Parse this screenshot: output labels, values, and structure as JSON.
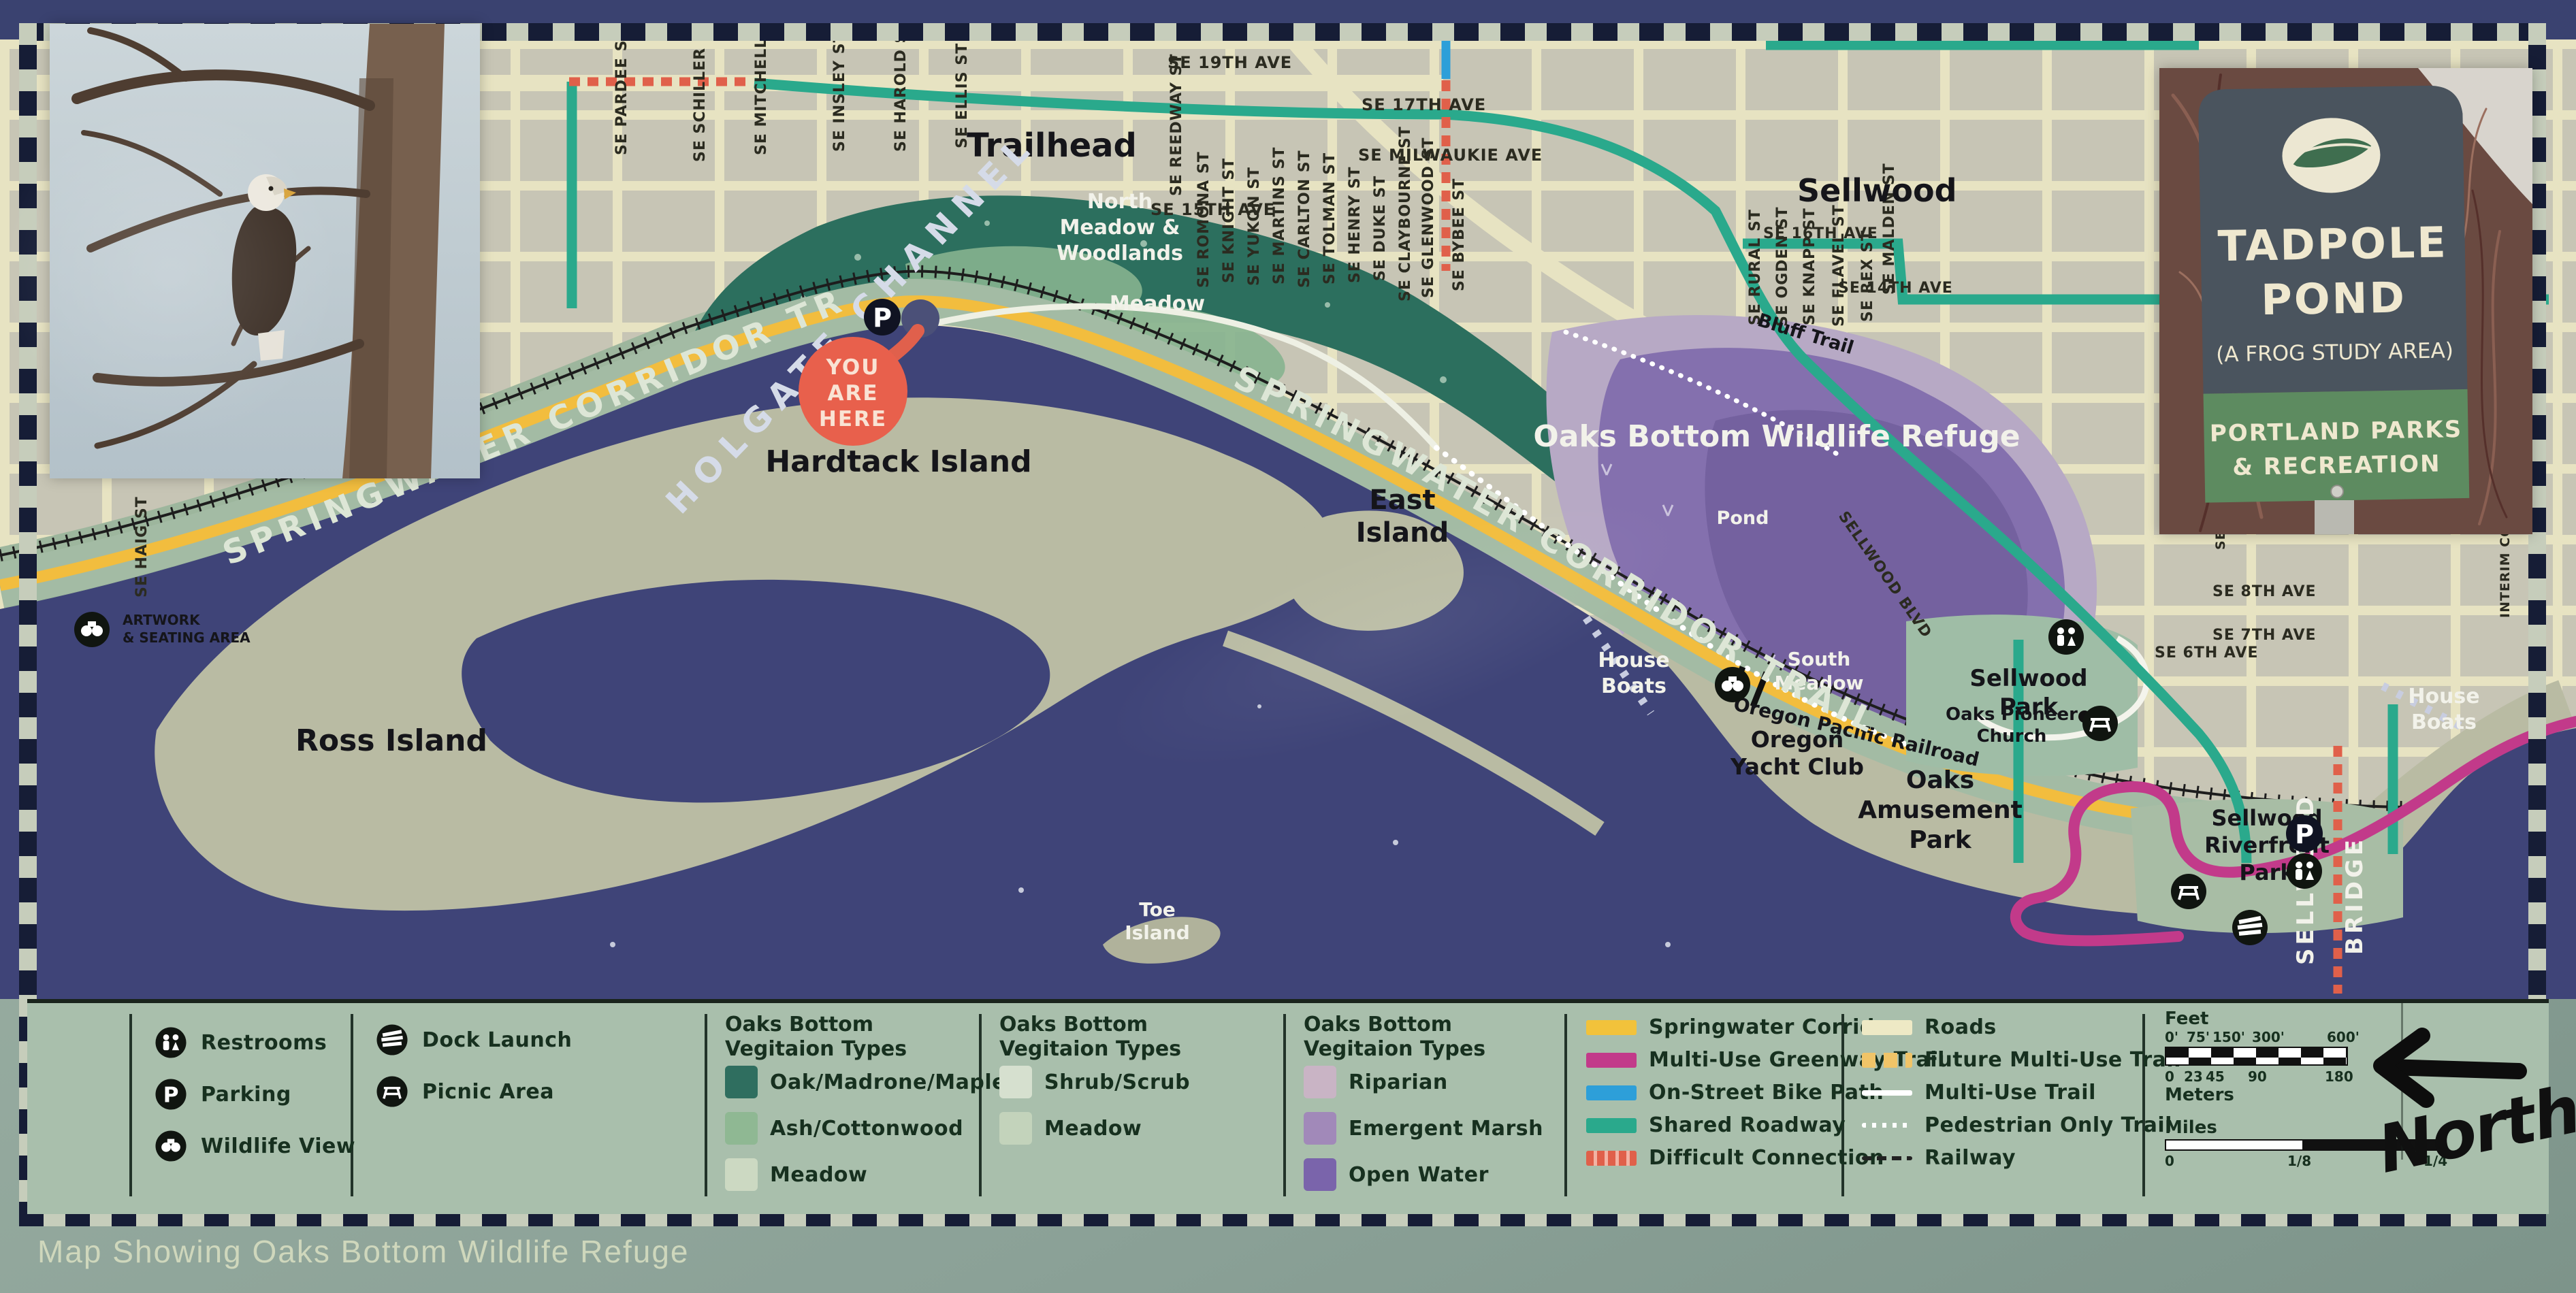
{
  "sign": {
    "caption": "Map Showing Oaks Bottom Wildlife Refuge"
  },
  "insets": {
    "tadpole_sign": {
      "title": [
        "TADPOLE",
        "POND"
      ],
      "subtitle": "(A FROG STUDY AREA)",
      "agency": [
        "PORTLAND PARKS",
        "& RECREATION"
      ],
      "colors": {
        "panel": "#4a545e",
        "band": "#5d8b60",
        "text": "#efe8cf"
      }
    }
  },
  "map": {
    "you_are_here": [
      "YOU",
      "ARE",
      "HERE"
    ],
    "you_are_here_color": "#e8604c",
    "labels": {
      "trailhead": "Trailhead",
      "sellwood": "Sellwood",
      "north_meadow": [
        "North",
        "Meadow &",
        "Woodlands"
      ],
      "meadow": "Meadow",
      "refuge": "Oaks Bottom Wildlife Refuge",
      "pond": "Pond",
      "bluff_trail": "Bluff Trail",
      "holgate_channel": "HOLGATE CHANNEL",
      "springwater_trail": "SPRINGWATER CORRIDOR TRAIL",
      "hardtack_island": "Hardtack Island",
      "east_island": [
        "East",
        "Island"
      ],
      "ross_island": "Ross Island",
      "toe_island": [
        "Toe",
        "Island"
      ],
      "house_boats": [
        "House",
        "Boats"
      ],
      "oregon_yacht_club": [
        "Oregon",
        "Yacht Club"
      ],
      "oaks_amusement_park": [
        "Oaks",
        "Amusement",
        "Park"
      ],
      "south_meadow": [
        "South",
        "Meadow"
      ],
      "sellwood_park": [
        "Sellwood",
        "Park"
      ],
      "oaks_pioneer_church": [
        "Oaks Pioneer",
        "Church"
      ],
      "sellwood_riverfront_park": [
        "Sellwood",
        "Riverfront",
        "Park"
      ],
      "sellwood_bridge": [
        "SELLWOOD",
        "BRIDGE"
      ],
      "oregon_pacific_railroad": "Oregon Pacific Railroad",
      "artwork_seating": [
        "ARTWORK",
        "& SEATING AREA"
      ]
    },
    "streets": [
      {
        "text": "SE HAIG ST"
      },
      {
        "text": "SE PARDEE ST"
      },
      {
        "text": "SE SCHILLER ST"
      },
      {
        "text": "SE MITCHELL ST"
      },
      {
        "text": "SE INSLEY ST"
      },
      {
        "text": "SE HAROLD ST"
      },
      {
        "text": "SE ELLIS ST"
      },
      {
        "text": "SE 19TH AVE"
      },
      {
        "text": "SE REEDWAY ST"
      },
      {
        "text": "SE 17TH AVE"
      },
      {
        "text": "SE MILWAUKIE AVE"
      },
      {
        "text": "SE 15TH AVE"
      },
      {
        "text": "SE ROMONA ST"
      },
      {
        "text": "SE KNIGHT ST"
      },
      {
        "text": "SE YUKON ST"
      },
      {
        "text": "SE MARTINS ST"
      },
      {
        "text": "SE CARLTON ST"
      },
      {
        "text": "SE TOLMAN ST"
      },
      {
        "text": "SE HENRY ST"
      },
      {
        "text": "SE DUKE ST"
      },
      {
        "text": "SE CLAYBOURNE ST"
      },
      {
        "text": "SE GLENWOOD ST"
      },
      {
        "text": "SE BYBEE ST"
      },
      {
        "text": "SE 16TH AVE"
      },
      {
        "text": "SE RURAL ST"
      },
      {
        "text": "SE OGDEN ST"
      },
      {
        "text": "SE KNAPP ST"
      },
      {
        "text": "SE FLAVEL ST"
      },
      {
        "text": "SE REX ST"
      },
      {
        "text": "SE MALDEN ST"
      },
      {
        "text": "SE 14TH AVE"
      },
      {
        "text": "SE 8TH AVE"
      },
      {
        "text": "SE 7TH AVE"
      },
      {
        "text": "SE 6TH AVE"
      },
      {
        "text": "SE LAMBERT ST"
      },
      {
        "text": "SE CLATSOP ST"
      },
      {
        "text": "INTERIM CONN"
      },
      {
        "text": "SELLWOOD BLVD"
      }
    ]
  },
  "legend": {
    "facilities": [
      {
        "label": "Restrooms",
        "icon": "restrooms-icon"
      },
      {
        "label": "Parking",
        "icon": "parking-icon"
      },
      {
        "label": "Wildlife View",
        "icon": "wildlife-view-icon"
      },
      {
        "label": "Dock Launch",
        "icon": "dock-launch-icon"
      },
      {
        "label": "Picnic Area",
        "icon": "picnic-area-icon"
      }
    ],
    "icons": {
      "parking_glyph": "P"
    },
    "veg_header": [
      "Oaks Bottom",
      "Vegitaion Types"
    ],
    "veg_types_1": [
      {
        "label": "Oak/Madrone/Maple",
        "color": "#2f6e5f"
      },
      {
        "label": "Ash/Cottonwood",
        "color": "#8fb893"
      },
      {
        "label": "Meadow",
        "color": "#ccd9c2"
      }
    ],
    "veg_types_2": [
      {
        "label": "Shrub/Scrub",
        "color": "#d6e0cf"
      },
      {
        "label": "Meadow",
        "color": "#c3d3bb"
      }
    ],
    "veg_types_3": [
      {
        "label": "Riparian",
        "color": "#c9b4c5"
      },
      {
        "label": "Emergent Marsh",
        "color": "#a189b9"
      },
      {
        "label": "Open Water",
        "color": "#7a64ab"
      }
    ],
    "trail_types": [
      {
        "label": "Springwater Corridor",
        "color": "#f2c23b"
      },
      {
        "label": "Multi-Use Greenway Trail",
        "color": "#c23a8a"
      },
      {
        "label": "On-Street Bike Path",
        "color": "#2d9fd9"
      },
      {
        "label": "Shared Roadway",
        "color": "#2aa98c"
      },
      {
        "label": "Difficult Connection",
        "color": "#e0604a"
      }
    ],
    "route_types": [
      {
        "label": "Roads",
        "color": "#eee9c5"
      },
      {
        "label": "Future Multi-Use Trail",
        "color": "#f0c468"
      },
      {
        "label": "Multi-Use Trail",
        "color": "#ffffff"
      },
      {
        "label": "Pedestrian Only Trail",
        "color": "#ffffff"
      },
      {
        "label": "Railway",
        "color": "#222222"
      }
    ],
    "scale": {
      "feet_label": "Feet",
      "feet_ticks": [
        "0'",
        "75'",
        "150'",
        "300'",
        "600'"
      ],
      "meters_label": "Meters",
      "meters_ticks": [
        "0",
        "23",
        "45",
        "90",
        "180"
      ],
      "miles_label": "Miles",
      "miles_ticks": [
        "0",
        "1/8",
        "1/4"
      ]
    },
    "north_label": "North"
  }
}
